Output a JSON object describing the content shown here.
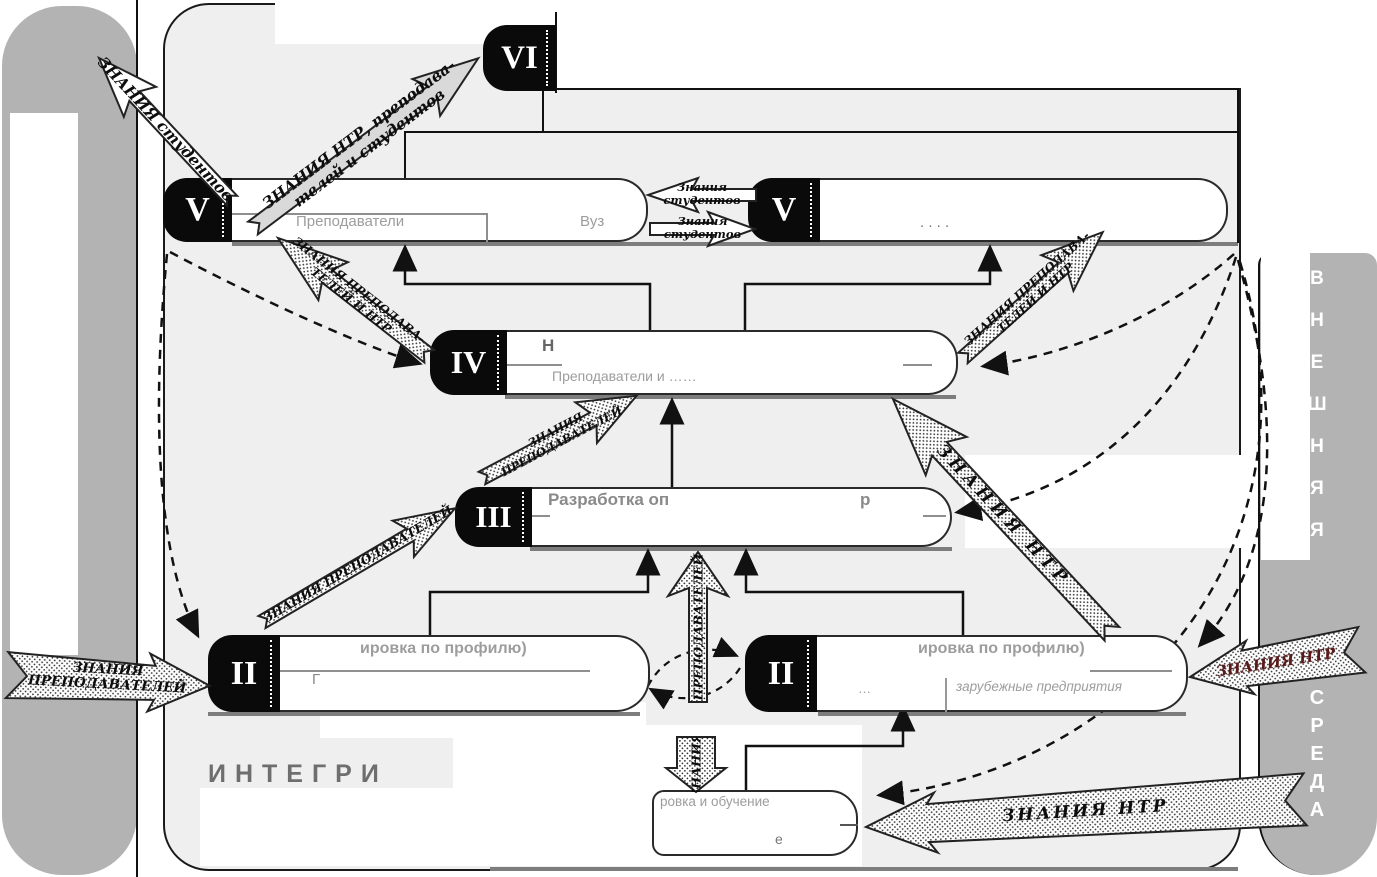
{
  "bars": {
    "right_top_text": "В\nН\nЕ\nШ\nН\nЯ\nЯ",
    "right_bottom_text": "С\nР\nЕ\nД\nА"
  },
  "stages": {
    "vi": "VI",
    "v_left": "V",
    "v_right": "V",
    "iv": "IV",
    "iii": "III",
    "ii_left": "II",
    "ii_right": "II"
  },
  "boxes": {
    "v_left_line2": "Преподаватели",
    "v_left_fragment": "Вуз",
    "v_right_fragment": ". . . .",
    "iv_line1": "Н",
    "iv_line2": "Преподаватели и ……",
    "iii_line1": "Разработка оп",
    "iii_fragment": "р",
    "ii_left_line1": "ировка по профилю)",
    "ii_left_line2": "Г",
    "ii_right_line1": "ировка по профилю)",
    "ii_right_line2_prefix": "…",
    "ii_right_line2": "зарубежные предприятия",
    "bottom_line1": "ровка и обучение",
    "bottom_fragment": "е",
    "integr_fragment": "ИНТЕГРИ"
  },
  "arrows": {
    "students_up": "ЗНАНИЯ студентов",
    "ntr_prep_students": "ЗНАНИЯ НТР, преподава-\nтелей и студентов",
    "students_left": "Знания\nстудентов",
    "students_right": "Знания\nстудентов",
    "prep_ntr_left": "ЗНАНИЯ ПРЕПОДАВА-\nТЕЛЕЙ И НТР",
    "prep_ntr_right": "ЗНАНИЯ ПРЕПОДАВА-\nТЕЛЕЙ И НТР",
    "prep_diag_to_iv": "ЗНАНИЯ\nПРЕПОДАВАТЕЛЕЙ",
    "prep_diag_to_iii": "ЗНАНИЯ ПРЕПОДАВАТЕЛЕЙ",
    "prep_vert_top": "ПРЕПОДАВАТЕЛЕЙ",
    "prep_vert_bottom": "ЗНАНИЯ",
    "prep_horiz": "ЗНАНИЯ\nПРЕПОДАВАТЕЛЕЙ",
    "ntr_diag": "ЗНАНИЯ  НТР",
    "ntr_right": "ЗНАНИЯ НТР",
    "ntr_bottom": "ЗНАНИЯ  НТР"
  },
  "colors": {
    "panel_bg": "#efefef",
    "sidebar_gray": "#b3b3b3",
    "big_arrow_gray": "#d9d9d9",
    "tab_black": "#0a0a0a",
    "ntr_right_text": "#5a1a1a",
    "faint_text": "#9d9d9d"
  }
}
